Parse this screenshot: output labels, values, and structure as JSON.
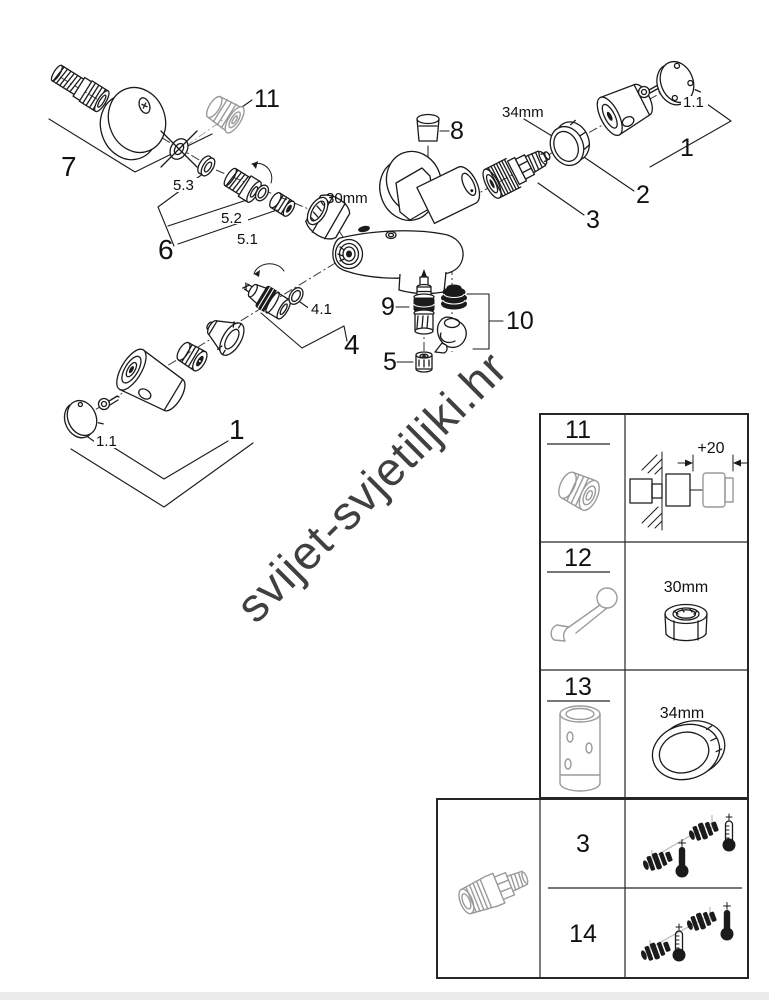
{
  "watermark": {
    "text": "svijet-svjetiljki.hr"
  },
  "colors": {
    "line": "#1b1b1b",
    "gray_part": "#9a9a9a",
    "watermark": "#d9d9d9",
    "footer_bar": "#ececec"
  },
  "diagram": {
    "callouts": {
      "c7": "7",
      "c11": "11",
      "c53": "5.3",
      "c52": "5.2",
      "c51": "5.1",
      "c6": "6",
      "dim30": "30mm",
      "c8": "8",
      "dim34": "34mm",
      "c11_top": "1.1",
      "c1_top": "1",
      "c2": "2",
      "c3": "3",
      "c9": "9",
      "c10": "10",
      "c41": "4.1",
      "c4": "4",
      "c5": "5",
      "c11_bot": "1.1",
      "c1_bot": "1"
    }
  },
  "reference_table": {
    "rows": [
      {
        "num": "11",
        "dim": "+20"
      },
      {
        "num": "12",
        "dim": "30mm"
      },
      {
        "num": "13",
        "dim": "34mm"
      }
    ]
  },
  "variant_table": {
    "rows": [
      {
        "num": "3"
      },
      {
        "num": "14"
      }
    ]
  }
}
